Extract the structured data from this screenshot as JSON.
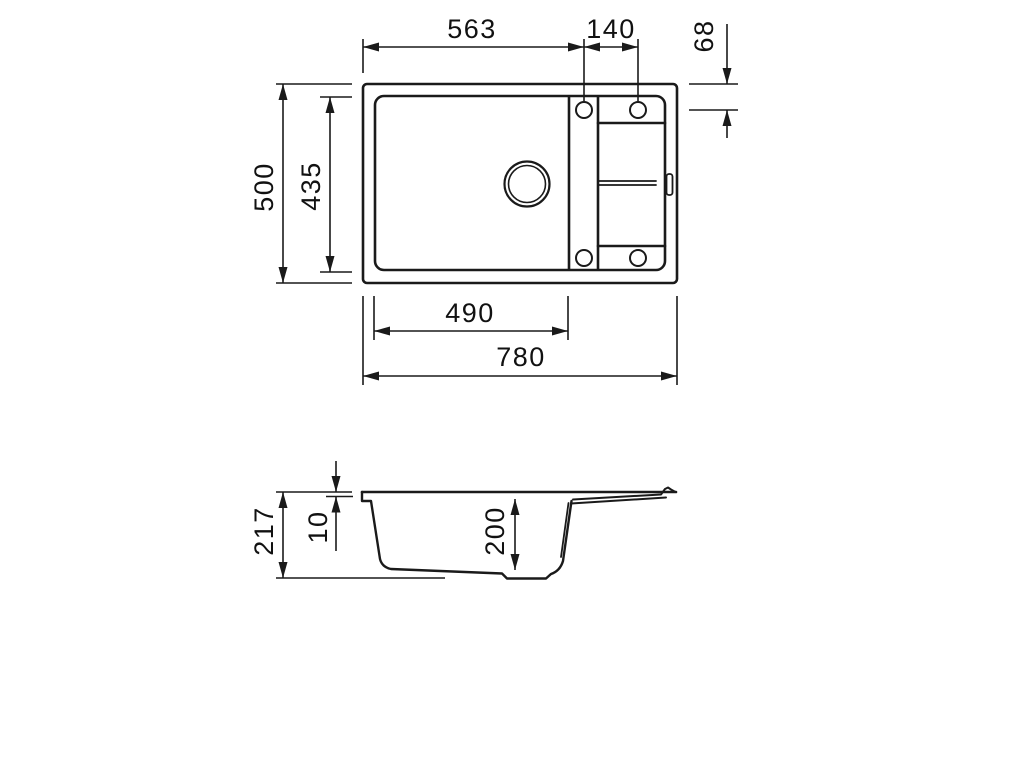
{
  "drawing_title": "Sink technical drawing",
  "colors": {
    "background": "#ffffff",
    "line": "#1a1a1a",
    "text": "#111111"
  },
  "views": {
    "top": {
      "dims": {
        "edge_to_tap_hole": "563",
        "tap_hole_spacing": "140",
        "tap_hole_top_offset": "68",
        "overall_depth": "500",
        "inner_depth": "435",
        "bowl_width": "490",
        "overall_width": "780"
      }
    },
    "section": {
      "dims": {
        "overall_height": "217",
        "rim_thickness": "10",
        "bowl_depth": "200"
      }
    }
  }
}
